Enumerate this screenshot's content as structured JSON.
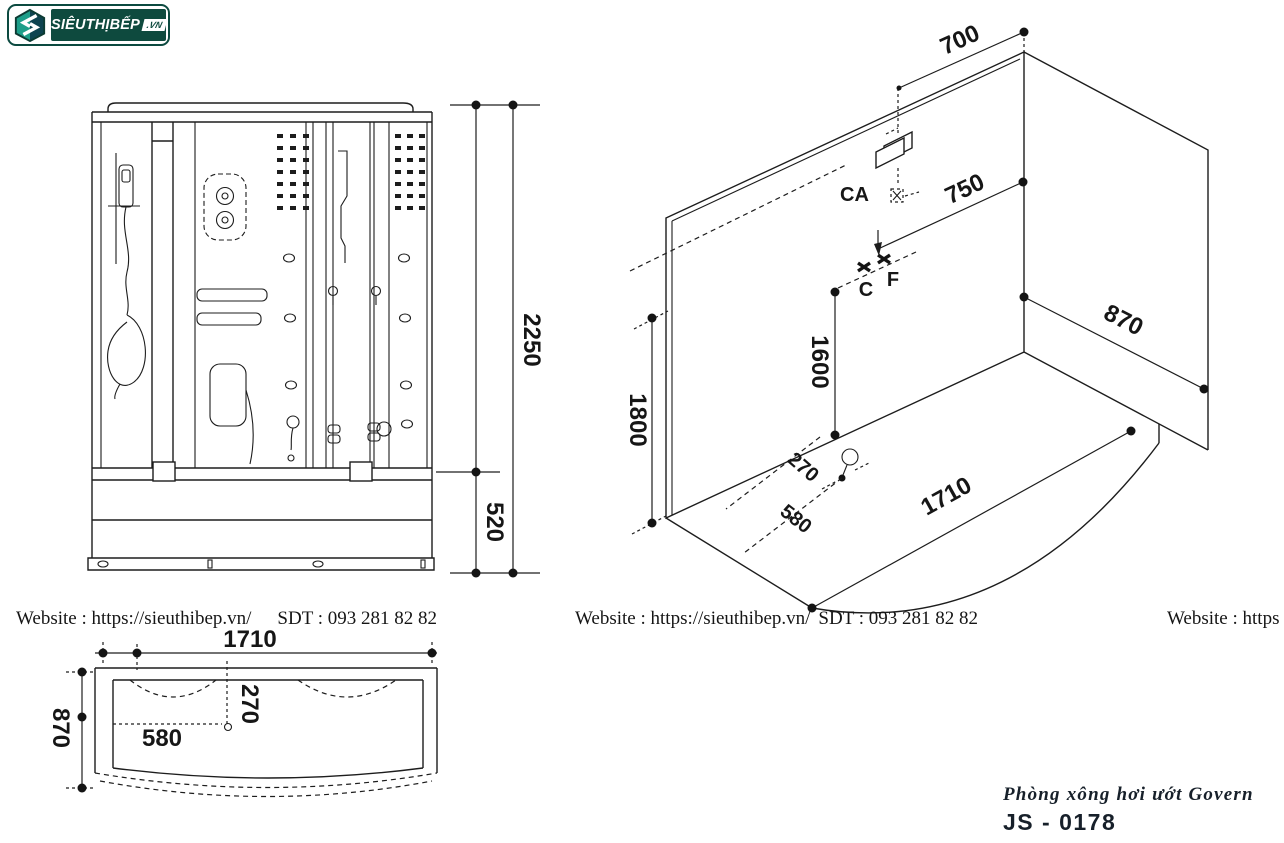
{
  "logo": {
    "brand": "SIÊUTHỊBẾP",
    "tld": ".VN"
  },
  "contacts": {
    "line1_website": "Website : https://sieuthibep.vn/",
    "line1_phone": "SDT : 093 281 82 82",
    "line2_website": "Website : https://sieuthibep.vn/",
    "line2_phone": "SDT : 093 281 82 82",
    "line3_website": "Website : https"
  },
  "product": {
    "name": "Phòng xông hơi ướt Govern",
    "model": "JS - 0178"
  },
  "front_view": {
    "dim_total_height": "2250",
    "dim_base_height": "520"
  },
  "iso_view": {
    "dim_top_offset": "700",
    "dim_shower_offset": "750",
    "dim_depth": "870",
    "dim_mixer_height": "1600",
    "dim_panel_height": "1800",
    "dim_drain_offset_short": "270",
    "dim_drain_offset_long": "580",
    "dim_width": "1710",
    "label_ca": "CA",
    "label_c": "C",
    "label_f": "F"
  },
  "plan_view": {
    "dim_width": "1710",
    "dim_depth": "870",
    "dim_drain_x": "580",
    "dim_drain_y": "270"
  },
  "colors": {
    "line": "#1d1d1d",
    "brand_green": "#0e4a3e",
    "brand_teal": "#1d9e89"
  }
}
